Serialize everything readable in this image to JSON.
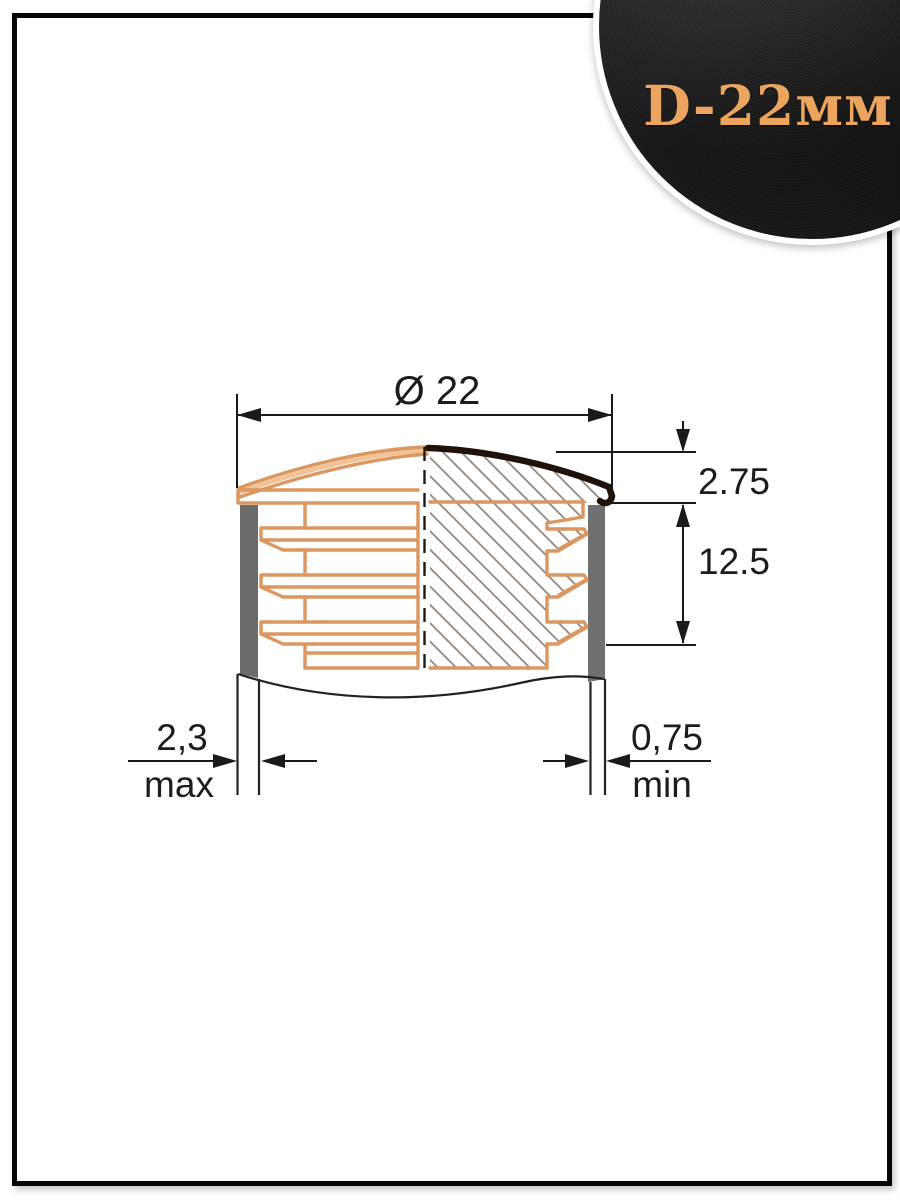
{
  "badge": {
    "label": "D-22мм",
    "text_color": "#ECA55F",
    "background_color": "#212121",
    "ring_color": "#ffffff"
  },
  "drawing": {
    "title_dimension": {
      "label": "Ø 22"
    },
    "cap_height": {
      "value": "2.75"
    },
    "insert_depth": {
      "value": "12.5"
    },
    "wall_thickness_left": {
      "value": "2,3",
      "qualifier": "max"
    },
    "wall_thickness_right": {
      "value": "0,75",
      "qualifier": "min"
    },
    "colors": {
      "plug_outline": "#DC9660",
      "section_hatch": "#8E8076",
      "tube_wall_fill": "#6B6B6B",
      "cap_top_edge": "#201209",
      "dimension_ink": "#1C1C1C",
      "frame_border": "#060606"
    }
  }
}
